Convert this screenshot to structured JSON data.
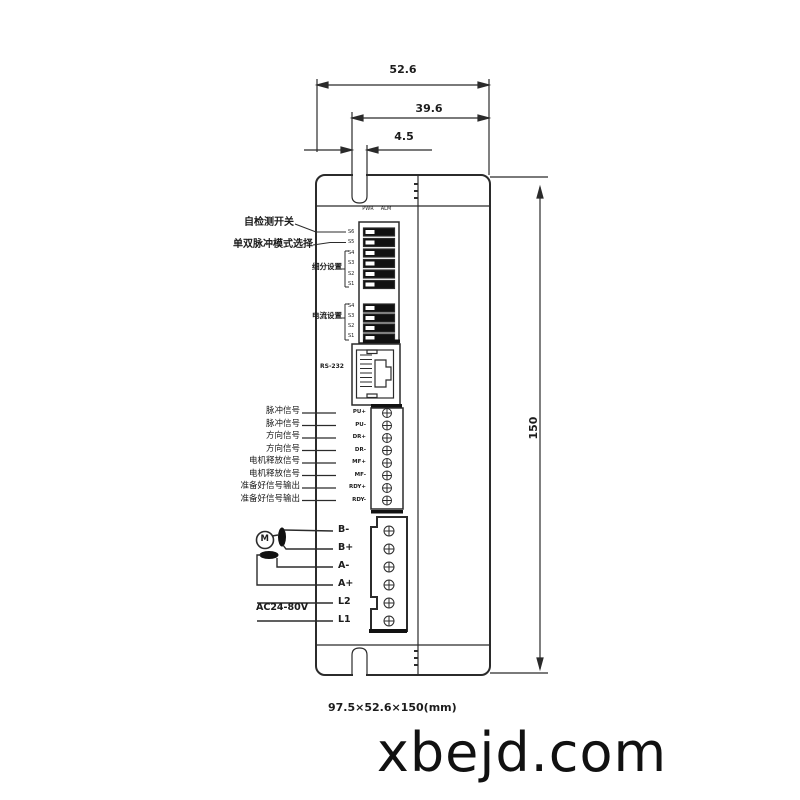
{
  "watermark": "xbejd.com",
  "footer_size_text": "97.5×52.6×150(mm)",
  "dimensions": {
    "top_width": "52.6",
    "mid_width": "39.6",
    "slot_width": "4.5",
    "height": "150"
  },
  "leds": {
    "pwr": "PWR",
    "alm": "ALM"
  },
  "dip": {
    "upper_labels": [
      "S6",
      "S5",
      "S4",
      "S3",
      "S2",
      "S1"
    ],
    "lower_labels": [
      "S4",
      "S3",
      "S2",
      "S1"
    ]
  },
  "annotations": {
    "self_test": "自检测开关",
    "pulse_mode": "单双脉冲模式选择",
    "microstep": "细分设置",
    "current": "电流设置",
    "rs232": "RS-232",
    "ac_input": "AC24-80V",
    "motor": "M"
  },
  "signal_rows": [
    {
      "label": "脉冲信号",
      "pin": "PU+"
    },
    {
      "label": "脉冲信号",
      "pin": "PU-"
    },
    {
      "label": "方向信号",
      "pin": "DR+"
    },
    {
      "label": "方向信号",
      "pin": "DR-"
    },
    {
      "label": "电机释放信号",
      "pin": "MF+"
    },
    {
      "label": "电机释放信号",
      "pin": "MF-"
    },
    {
      "label": "准备好信号输出",
      "pin": "RDY+"
    },
    {
      "label": "准备好信号输出",
      "pin": "RDY-"
    }
  ],
  "power_pins": [
    "B-",
    "B+",
    "A-",
    "A+",
    "L2",
    "L1"
  ]
}
